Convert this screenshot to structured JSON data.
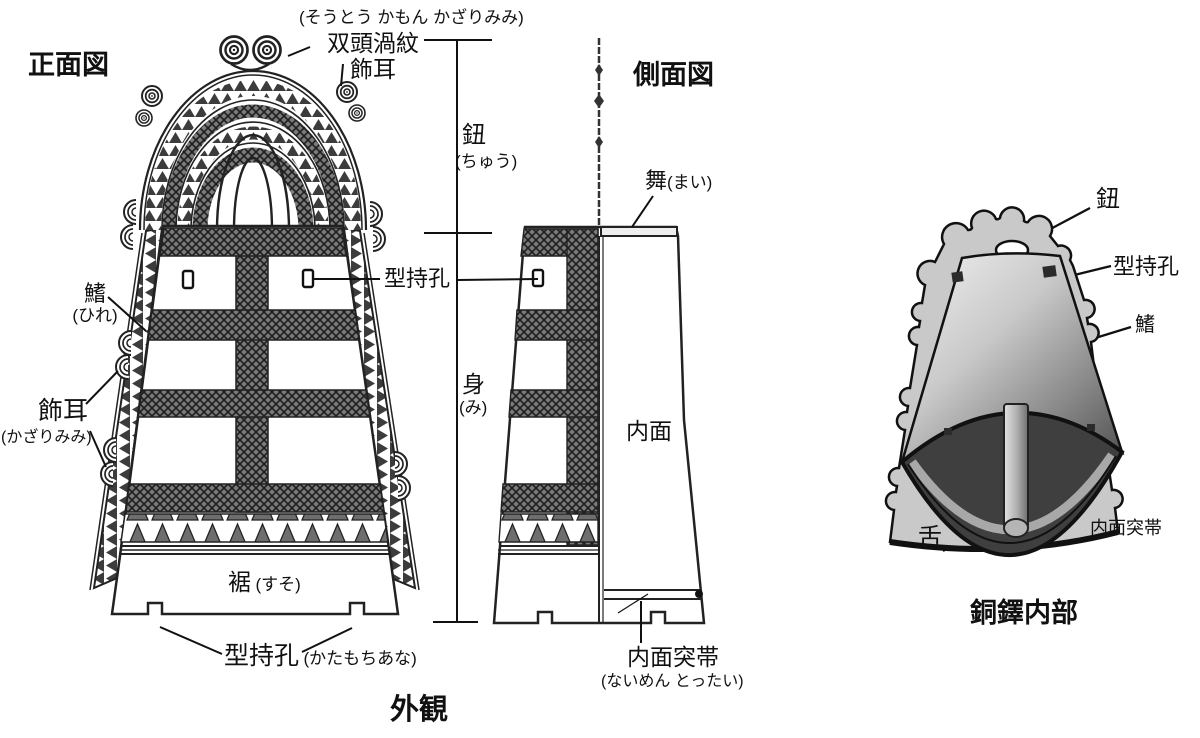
{
  "caption": "外観",
  "colors": {
    "ink": "#1a1a1a",
    "hatch_gray": "#7a7a7a",
    "flange_gray": "#c9c9c9",
    "interior_dark": "#3f3f3f",
    "band_gray": "#a8a8a8"
  },
  "front_view": {
    "title": "正面図",
    "ornament_furigana": "(そうとう かもん かざりみみ)",
    "ornament_line1": "双頭渦紋",
    "ornament_line2": "飾耳",
    "fin": "鰭",
    "fin_furigana": "(ひれ)",
    "ear": "飾耳",
    "ear_furigana": "(かざりみみ)",
    "mold_hole": "型持孔",
    "skirt": "裾",
    "skirt_furigana": "(すそ)",
    "bottom_hole": "型持孔",
    "bottom_hole_furigana": "(かたもちあな)"
  },
  "dimension": {
    "handle": "鈕",
    "handle_furigana": "(ちゅう)",
    "body": "身",
    "body_furigana": "(み)"
  },
  "side_view": {
    "title": "側面図",
    "top_face": "舞",
    "top_face_furigana": "(まい)",
    "inner_face": "内面",
    "inner_band": "内面突帯",
    "inner_band_furigana": "(ないめん とったい)"
  },
  "interior_view": {
    "caption": "銅鐸内部",
    "handle": "鈕",
    "mold_hole": "型持孔",
    "fin": "鰭",
    "clapper": "舌",
    "inner_band": "内面突帯"
  }
}
